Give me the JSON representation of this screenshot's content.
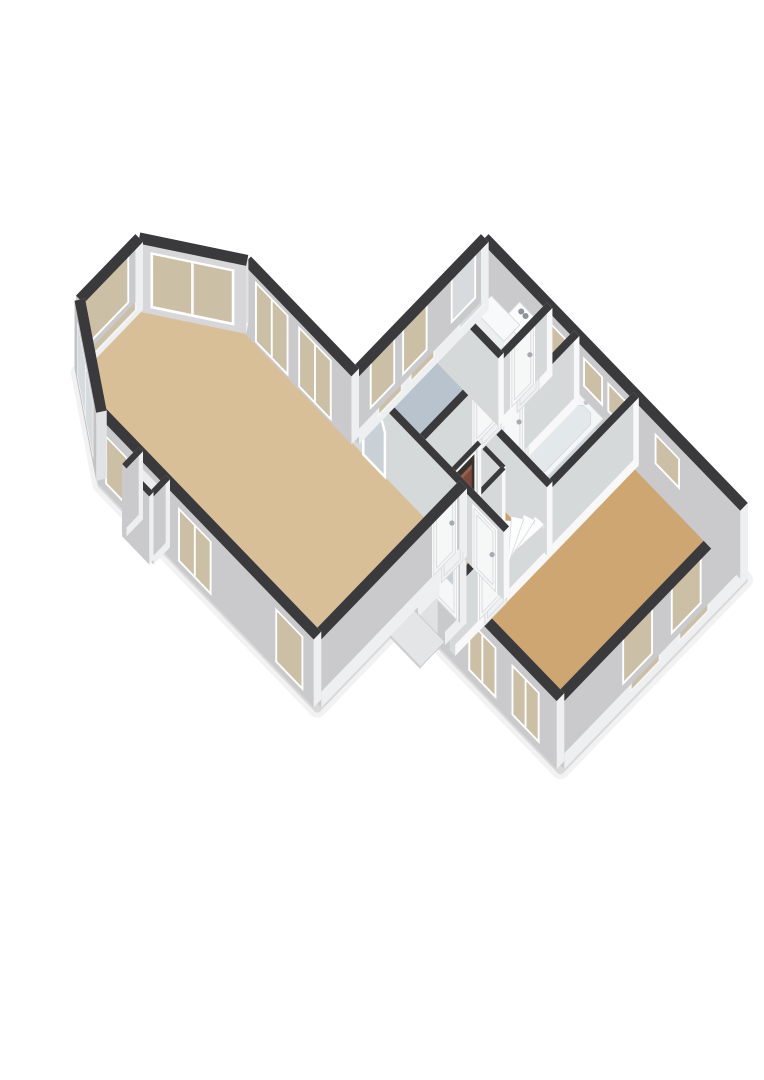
{
  "scene": {
    "kind": "floorplan-3d",
    "bg": "#ffffff",
    "projection": {
      "a": 27,
      "b": 28,
      "z": 34,
      "ox": 96,
      "oy": 474
    },
    "palette": {
      "cap": "#3a3a3c",
      "extDark": "#c2c3c5",
      "extLight": "#f6f6f7",
      "intDark": "#cfd2d4",
      "intLight": "#ffffff",
      "frameBright": "#ffffff",
      "frameDim": "#f3f4f5",
      "glassBeige": "#cbbfa6",
      "glassFrost": "#d7dbdd",
      "glassDoor": "#c9cfd3",
      "archFill": "#c9d0d6",
      "gapFill": "#ececed",
      "openDark": "#37322f",
      "boiler": "#7c4a3b",
      "boilerTop": "#96604e",
      "stairTop": "#fcfdfd",
      "stairRiser": "#e8ebed",
      "stairStroke": "#d5d8da",
      "doorLeafBright": "#f6f7f7",
      "doorLeafDim": "#eff1f2",
      "doorStroke": "#dcdee0",
      "handle": "#a6abaf",
      "shadow1": "rgba(0,0,0,0.10)",
      "shadow2": "rgba(0,0,0,0.05)"
    },
    "wallHeight": 2.0,
    "shadowOutline": [
      [
        0.2,
        0
      ],
      [
        8.2,
        0
      ],
      [
        8.2,
        3.4
      ],
      [
        13.8,
        3.4
      ],
      [
        13.8,
        10.2
      ],
      [
        4.2,
        10.2
      ],
      [
        4.2,
        5.4
      ],
      [
        0.2,
        5.4
      ],
      [
        -2.2,
        3.8
      ],
      [
        -2.2,
        1.6
      ]
    ],
    "floors": [
      {
        "name": "floor-living-room",
        "color": "#d8bf97",
        "points": [
          [
            0.2,
            0
          ],
          [
            8.2,
            0
          ],
          [
            8.2,
            5.4
          ],
          [
            0.2,
            5.4
          ],
          [
            -2.2,
            3.8
          ],
          [
            -2.2,
            1.6
          ]
        ]
      },
      {
        "name": "floor-fireplace-niche",
        "color": "#d8bf97",
        "points": [
          [
            1.6,
            -0.55
          ],
          [
            2.6,
            -0.55
          ],
          [
            2.6,
            0.06
          ],
          [
            1.6,
            0.06
          ]
        ]
      },
      {
        "name": "floor-study",
        "color": "#b9c3cd",
        "points": [
          [
            4.2,
            5.4
          ],
          [
            6.6,
            5.4
          ],
          [
            6.6,
            8.4
          ],
          [
            4.2,
            8.4
          ]
        ]
      },
      {
        "name": "floor-utility",
        "color": "#c4ced6",
        "points": [
          [
            4.2,
            8.4
          ],
          [
            6.6,
            8.4
          ],
          [
            6.6,
            10.2
          ],
          [
            4.2,
            10.2
          ]
        ]
      },
      {
        "name": "floor-corridor",
        "color": "#c6cfd6",
        "points": [
          [
            6.6,
            7.0
          ],
          [
            7.6,
            7.0
          ],
          [
            7.6,
            10.2
          ],
          [
            6.6,
            10.2
          ]
        ]
      },
      {
        "name": "floor-bathroom",
        "color": "#cfd7dd",
        "points": [
          [
            7.6,
            7.0
          ],
          [
            9.8,
            7.0
          ],
          [
            9.8,
            10.2
          ],
          [
            7.6,
            10.2
          ]
        ]
      },
      {
        "name": "floor-hall",
        "color": "#cba26a",
        "points": [
          [
            6.6,
            5.4
          ],
          [
            9.8,
            5.4
          ],
          [
            9.8,
            7.0
          ],
          [
            6.6,
            7.0
          ]
        ]
      },
      {
        "name": "floor-vestibule",
        "color": "#cba26a",
        "points": [
          [
            8.2,
            4.2
          ],
          [
            9.8,
            4.2
          ],
          [
            9.8,
            5.4
          ],
          [
            8.2,
            5.4
          ]
        ]
      },
      {
        "name": "floor-bedroom",
        "color": "#cda671",
        "points": [
          [
            9.8,
            3.4
          ],
          [
            13.8,
            3.4
          ],
          [
            13.8,
            10.2
          ],
          [
            9.8,
            10.2
          ]
        ]
      },
      {
        "name": "floor-porch-recess",
        "color": "#e0e1e2",
        "points": [
          [
            8.4,
            3.4
          ],
          [
            9.4,
            3.4
          ],
          [
            9.4,
            4.2
          ],
          [
            8.4,
            4.2
          ]
        ]
      }
    ],
    "walls": [
      {
        "name": "wall-bay-sw",
        "x1": 0.2,
        "y1": 0,
        "x2": -2.2,
        "y2": 1.6,
        "t": 0.28,
        "ext": true,
        "openings": [
          {
            "type": "window",
            "a0": 0.45,
            "a1": 2.45,
            "z0": 0.25,
            "z1": 1.75,
            "glass": "frost",
            "panes": 2
          }
        ]
      },
      {
        "name": "wall-bay-west",
        "x1": -2.2,
        "y1": 1.6,
        "x2": -2.2,
        "y2": 3.8,
        "t": 0.28,
        "ext": true,
        "openings": [
          {
            "type": "window",
            "a0": 0.3,
            "a1": 1.9,
            "z0": 0.25,
            "z1": 1.75,
            "glass": "beige",
            "panes": 1
          }
        ]
      },
      {
        "name": "wall-bay-nw",
        "x1": -2.2,
        "y1": 3.8,
        "x2": 0.2,
        "y2": 5.4,
        "t": 0.28,
        "ext": true,
        "openings": [
          {
            "type": "window",
            "a0": 0.4,
            "a1": 2.5,
            "z0": 0.25,
            "z1": 1.75,
            "glass": "beige",
            "panes": 2
          }
        ]
      },
      {
        "name": "wall-living-north",
        "x1": 0.2,
        "y1": 5.4,
        "x2": 4.2,
        "y2": 5.4,
        "t": 0.28,
        "ext": true,
        "openings": [
          {
            "type": "window",
            "a0": 0.5,
            "a1": 1.6,
            "z0": 0.15,
            "z1": 1.8,
            "glass": "beige",
            "panes": 2
          },
          {
            "type": "window",
            "a0": 2.1,
            "a1": 3.2,
            "z0": 0.15,
            "z1": 1.8,
            "glass": "beige",
            "panes": 2
          }
        ]
      },
      {
        "name": "wall-rear-west",
        "x1": 4.2,
        "y1": 5.4,
        "x2": 4.2,
        "y2": 10.2,
        "t": 0.28,
        "ext": true,
        "openings": [
          {
            "type": "window",
            "a0": 0.75,
            "a1": 1.55,
            "z0": 0.3,
            "z1": 1.72,
            "glass": "beige",
            "panes": 1
          },
          {
            "type": "window",
            "a0": 1.95,
            "a1": 2.75,
            "z0": 0.3,
            "z1": 1.72,
            "glass": "beige",
            "panes": 1
          },
          {
            "type": "window",
            "a0": 3.75,
            "a1": 4.55,
            "z0": 0.35,
            "z1": 1.78,
            "glass": "frost",
            "panes": 1
          }
        ]
      },
      {
        "name": "wall-north",
        "x1": 4.2,
        "y1": 10.2,
        "x2": 13.8,
        "y2": 10.2,
        "t": 0.28,
        "ext": true,
        "openings": [
          {
            "type": "window",
            "a0": 2.5,
            "a1": 3.1,
            "z0": 0.95,
            "z1": 1.68,
            "glass": "beige",
            "panes": 1
          },
          {
            "type": "window",
            "a0": 3.85,
            "a1": 4.45,
            "z0": 0.95,
            "z1": 1.68,
            "glass": "beige",
            "panes": 1
          },
          {
            "type": "window",
            "a0": 4.75,
            "a1": 5.35,
            "z0": 0.95,
            "z1": 1.68,
            "glass": "beige",
            "panes": 1
          },
          {
            "type": "window",
            "a0": 6.5,
            "a1": 7.3,
            "z0": 0.85,
            "z1": 1.62,
            "glass": "beige",
            "panes": 1
          }
        ]
      },
      {
        "name": "wall-east",
        "x1": 13.8,
        "y1": 10.2,
        "x2": 13.8,
        "y2": 3.4,
        "t": 0.28,
        "ext": true,
        "openings": [
          {
            "type": "window",
            "a0": 1.5,
            "a1": 2.5,
            "z0": 0.3,
            "z1": 1.62,
            "glass": "beige",
            "panes": 1
          },
          {
            "type": "window",
            "a0": 3.3,
            "a1": 4.3,
            "z0": 0.3,
            "z1": 1.62,
            "glass": "beige",
            "panes": 1
          }
        ]
      },
      {
        "name": "wall-south-east",
        "x1": 13.8,
        "y1": 3.4,
        "x2": 9.4,
        "y2": 3.4,
        "t": 0.28,
        "ext": true,
        "openings": [
          {
            "type": "window",
            "a0": 0.7,
            "a1": 1.6,
            "z0": 0.3,
            "z1": 1.66,
            "glass": "beige",
            "panes": 2
          },
          {
            "type": "window",
            "a0": 2.3,
            "a1": 3.2,
            "z0": 0.3,
            "z1": 1.66,
            "glass": "beige",
            "panes": 2
          }
        ]
      },
      {
        "name": "wall-porch-east",
        "x1": 9.4,
        "y1": 3.4,
        "x2": 9.4,
        "y2": 4.2,
        "t": 0.24,
        "ext": true,
        "openings": []
      },
      {
        "name": "wall-entry",
        "x1": 9.4,
        "y1": 4.2,
        "x2": 8.4,
        "y2": 4.2,
        "t": 0.24,
        "ext": true,
        "openings": [
          {
            "type": "door",
            "a0": 0.12,
            "a1": 0.9,
            "z1": 1.82,
            "glass": true
          }
        ]
      },
      {
        "name": "wall-porch-west",
        "x1": 8.4,
        "y1": 4.2,
        "x2": 8.4,
        "y2": 3.4,
        "t": 0.24,
        "ext": true,
        "openings": []
      },
      {
        "name": "wall-living-south",
        "x1": 8.2,
        "y1": 0,
        "x2": 0.2,
        "y2": 0,
        "t": 0.28,
        "ext": true,
        "openings": [
          {
            "type": "window",
            "a0": 0.45,
            "a1": 1.35,
            "z0": 0.25,
            "z1": 1.7,
            "glass": "beige",
            "panes": 1
          },
          {
            "type": "window",
            "a0": 3.85,
            "a1": 4.95,
            "z0": 0.25,
            "z1": 1.7,
            "glass": "beige",
            "panes": 2
          },
          {
            "type": "gap",
            "a0": 5.6,
            "a1": 6.6,
            "z0": 0,
            "z1": 1.8
          },
          {
            "type": "window",
            "a0": 6.95,
            "a1": 7.65,
            "z0": 0.3,
            "z1": 1.6,
            "glass": "beige",
            "panes": 1
          }
        ]
      },
      {
        "name": "wall-living-east",
        "x1": 8.2,
        "y1": 0,
        "x2": 8.2,
        "y2": 5.4,
        "t": 0.28,
        "ext": true,
        "openings": [
          {
            "type": "door",
            "a0": 4.45,
            "a1": 5.25,
            "z1": 1.8
          }
        ]
      },
      {
        "name": "wall-niche-west",
        "x1": 1.6,
        "y1": 0.06,
        "x2": 1.6,
        "y2": -0.55,
        "t": 0.16,
        "ext": true,
        "openings": []
      },
      {
        "name": "wall-niche-south",
        "x1": 1.6,
        "y1": -0.55,
        "x2": 2.6,
        "y2": -0.55,
        "t": 0.16,
        "ext": true,
        "openings": []
      },
      {
        "name": "wall-niche-east",
        "x1": 2.6,
        "y1": -0.55,
        "x2": 2.6,
        "y2": 0.06,
        "t": 0.16,
        "ext": true,
        "openings": []
      },
      {
        "name": "wall-living-rear",
        "x1": 4.2,
        "y1": 5.4,
        "x2": 9.8,
        "y2": 5.4,
        "t": 0.2,
        "ext": false,
        "openings": [
          {
            "type": "arch",
            "a0": 0.4,
            "a1": 1.2
          },
          {
            "type": "door",
            "a0": 4.5,
            "a1": 5.3,
            "z1": 1.8
          }
        ]
      },
      {
        "name": "wall-study-utility",
        "x1": 4.2,
        "y1": 8.4,
        "x2": 6.6,
        "y2": 8.4,
        "t": 0.2,
        "ext": false,
        "openings": []
      },
      {
        "name": "wall-corridor-west",
        "x1": 6.6,
        "y1": 5.4,
        "x2": 6.6,
        "y2": 10.2,
        "t": 0.2,
        "ext": false,
        "openings": [
          {
            "type": "door",
            "a0": 2.1,
            "a1": 2.9,
            "z1": 1.8
          },
          {
            "type": "door",
            "a0": 3.5,
            "a1": 4.3,
            "z1": 1.8
          }
        ]
      },
      {
        "name": "wall-bath-south",
        "x1": 7.6,
        "y1": 7.0,
        "x2": 9.8,
        "y2": 7.0,
        "t": 0.2,
        "ext": false,
        "openings": []
      },
      {
        "name": "wall-bath-west",
        "x1": 7.6,
        "y1": 7.0,
        "x2": 7.6,
        "y2": 10.2,
        "t": 0.2,
        "ext": false,
        "openings": [
          {
            "type": "door",
            "a0": 0.5,
            "a1": 1.3,
            "z1": 1.8
          }
        ]
      },
      {
        "name": "wall-bedroom-west-south",
        "x1": 9.8,
        "y1": 3.4,
        "x2": 9.8,
        "y2": 5.4,
        "t": 0.2,
        "ext": false,
        "openings": [
          {
            "type": "door",
            "a0": 1.1,
            "a1": 1.9,
            "z1": 1.8
          }
        ]
      },
      {
        "name": "wall-bedroom-west-mid",
        "x1": 9.8,
        "y1": 5.4,
        "x2": 9.8,
        "y2": 7.0,
        "t": 0.2,
        "ext": false,
        "openings": []
      },
      {
        "name": "wall-bedroom-west-north",
        "x1": 9.8,
        "y1": 7.0,
        "x2": 9.8,
        "y2": 10.2,
        "t": 0.2,
        "ext": false,
        "openings": []
      },
      {
        "name": "wall-closet-west",
        "x1": 7.75,
        "y1": 5.4,
        "x2": 7.75,
        "y2": 6.45,
        "t": 0.13,
        "ext": false,
        "openings": [
          {
            "type": "boiler",
            "a0": 0.12,
            "a1": 0.93,
            "z0": 0.15,
            "z1": 1.7
          }
        ]
      },
      {
        "name": "wall-closet-north",
        "x1": 7.75,
        "y1": 6.45,
        "x2": 8.65,
        "y2": 6.45,
        "t": 0.13,
        "ext": false,
        "openings": []
      },
      {
        "name": "wall-closet-east",
        "x1": 8.65,
        "y1": 6.45,
        "x2": 8.65,
        "y2": 5.4,
        "t": 0.13,
        "ext": false,
        "openings": []
      }
    ],
    "boxStyles": {
      "appliance": {
        "top": "#fbfcfc",
        "front": "#f1f3f4",
        "side": "#e3e6e8",
        "stroke": "#d8dbdd"
      },
      "counter": {
        "top": "#f8f9fa",
        "front": "#eceff0",
        "side": "#dfe2e4",
        "stroke": "#d5d8da"
      },
      "slab": {
        "top": "#e4e5e6",
        "front": "#d3d4d5",
        "side": "#cbccce",
        "stroke": "#c6c7c8"
      },
      "fixture": {
        "top": "#ffffff",
        "front": "#f0f2f3",
        "side": "#e4e7e9",
        "stroke": "#d8dadc"
      }
    },
    "fixtures": [
      {
        "type": "box",
        "name": "washing-machine",
        "x0": 5.55,
        "y0": 9.5,
        "x1": 6.35,
        "y1": 10.14,
        "h": 1.28,
        "style": "appliance",
        "dots": true
      },
      {
        "type": "box",
        "name": "utility-counter",
        "x0": 4.5,
        "y0": 9.56,
        "x1": 5.55,
        "y1": 10.14,
        "h": 0.6,
        "style": "counter"
      },
      {
        "type": "toilet",
        "name": "toilet",
        "x": 6.78,
        "y": 9.5,
        "w": 0.5,
        "d": 0.66
      },
      {
        "type": "tub",
        "name": "bathtub",
        "x0": 7.78,
        "y0": 7.72,
        "x1": 8.72,
        "y1": 10.06,
        "h": 0.52
      },
      {
        "type": "stairs",
        "name": "winder-stairs",
        "cx": 9.68,
        "cy": 5.56,
        "r": 1.28,
        "a0": 190,
        "a1": 86,
        "steps": 7,
        "rise": 0.13,
        "z0": 0.14,
        "key": 15.6
      },
      {
        "type": "box",
        "name": "porch-slab",
        "x0": 8.3,
        "y0": 2.52,
        "x1": 9.5,
        "y1": 3.42,
        "h": 0.07,
        "style": "slab"
      }
    ]
  }
}
